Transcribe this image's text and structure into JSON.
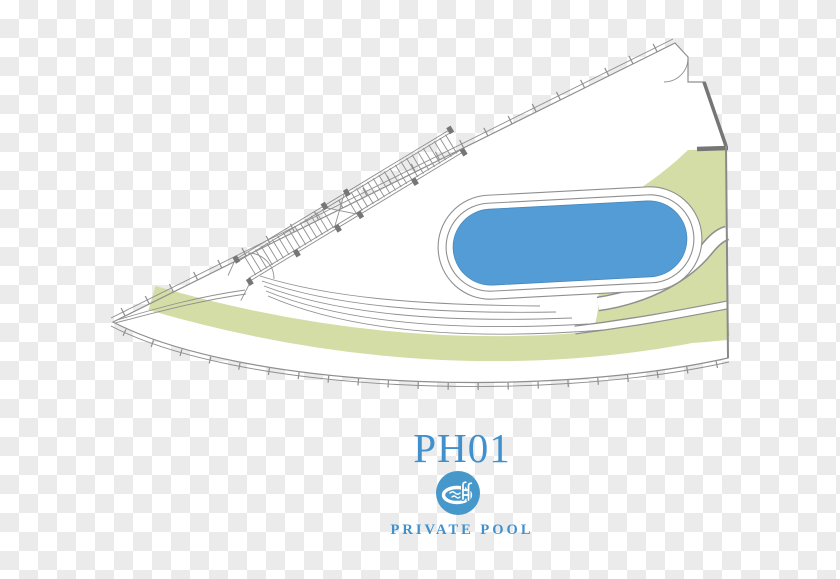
{
  "image": {
    "width": 840,
    "height": 579,
    "background": "transparency-checkerboard"
  },
  "floorplan": {
    "unit_id": "PH01",
    "feature_label": "PRIVATE POOL",
    "feature_icon": "pool-icon",
    "visible_features": [
      "private pool",
      "green planted bands",
      "curved terrace with railing",
      "diagonal stair structure",
      "door swings"
    ]
  },
  "colors": {
    "checker-gray": "#ebebeb",
    "line-gray": "#8f8f8f",
    "wall-dark": "#767676",
    "pool-blue": "#549cd5",
    "pool-edge": "#4688bd",
    "green": "#d3dda5",
    "text-blue": "#3f90cd",
    "icon-blue": "#4697ca"
  }
}
